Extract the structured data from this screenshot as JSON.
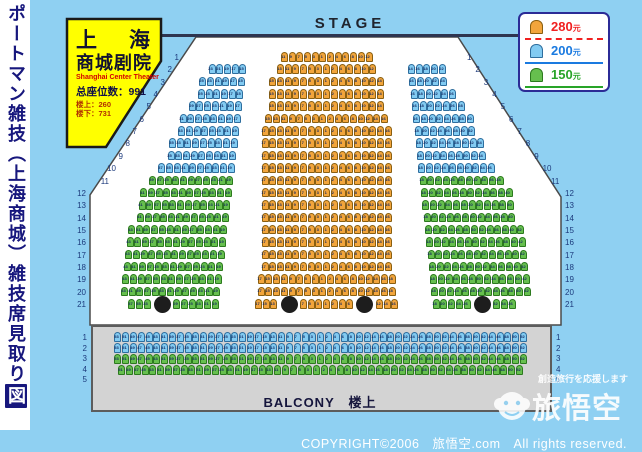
{
  "page": {
    "background": "#8fd0f2",
    "hall_fill": "#ffffff",
    "balcony_fill": "#d3d3d3"
  },
  "vertical_title": {
    "main": "ポートマン雑技（上海商城）雑技席見取り",
    "boxed": "図"
  },
  "stage": {
    "label": "STAGE"
  },
  "info_box": {
    "name_left": "上",
    "name_right": "海",
    "name_line2": "商城剧院",
    "name_en": "Shanghai Center Theater",
    "total_seats": "总座位数：991",
    "upstairs": "楼上：260",
    "downstairs": "楼下：731"
  },
  "legend": [
    {
      "price": "280",
      "unit": "元",
      "seat_color_key": "orange",
      "text_color": "#f02020",
      "underline": "dashed"
    },
    {
      "price": "200",
      "unit": "元",
      "seat_color_key": "blue",
      "text_color": "#1a7ae0",
      "underline": "solid"
    },
    {
      "price": "150",
      "unit": "元",
      "seat_color_key": "green",
      "text_color": "#28a428",
      "underline": "solid"
    }
  ],
  "seat_colors": {
    "orange": {
      "fill": "#f2a53c",
      "border": "#8a5f10"
    },
    "blue": {
      "fill": "#82cbf2",
      "border": "#2e6e9e"
    },
    "green": {
      "fill": "#66bf4e",
      "border": "#2c7a1e"
    }
  },
  "pillars": {
    "count": 4,
    "color": "#1d1d1d"
  },
  "floor": {
    "row_labels_left": [
      1,
      2,
      3,
      4,
      5,
      6,
      7,
      8,
      9,
      10,
      11,
      12,
      13,
      14,
      15,
      16,
      17,
      18,
      19,
      20,
      21
    ],
    "row_labels_right": [
      1,
      2,
      3,
      4,
      5,
      6,
      7,
      8,
      9,
      10,
      11,
      12,
      13,
      14,
      15,
      16,
      17,
      18,
      19,
      20,
      21
    ],
    "left_rows": [
      {
        "row": 2,
        "color": "blue",
        "odd_from": 23,
        "odd_to": 15
      },
      {
        "row": 3,
        "color": "blue",
        "odd_from": 25,
        "odd_to": 15
      },
      {
        "row": 4,
        "color": "blue",
        "odd_from": 25,
        "odd_to": 15
      },
      {
        "row": 5,
        "color": "blue",
        "odd_from": 29,
        "odd_to": 17
      },
      {
        "row": 6,
        "color": "blue",
        "odd_from": 31,
        "odd_to": 17
      },
      {
        "row": 7,
        "color": "blue",
        "odd_from": 33,
        "odd_to": 19
      },
      {
        "row": 8,
        "color": "blue",
        "odd_from": 35,
        "odd_to": 19
      },
      {
        "row": 9,
        "color": "blue",
        "odd_from": 35,
        "odd_to": 19
      },
      {
        "row": 10,
        "color": "blue",
        "odd_from": 37,
        "odd_to": 19
      },
      {
        "row": 11,
        "color": "green",
        "odd_from": 39,
        "odd_to": 19
      },
      {
        "row": 12,
        "color": "green",
        "odd_from": 41,
        "odd_to": 19
      },
      {
        "row": 13,
        "color": "green",
        "odd_from": 41,
        "odd_to": 19
      },
      {
        "row": 14,
        "color": "green",
        "odd_from": 41,
        "odd_to": 19
      },
      {
        "row": 15,
        "color": "green",
        "odd_from": 43,
        "odd_to": 19
      },
      {
        "row": 16,
        "color": "green",
        "odd_from": 43,
        "odd_to": 19
      },
      {
        "row": 17,
        "color": "green",
        "odd_from": 43,
        "odd_to": 19
      },
      {
        "row": 18,
        "color": "green",
        "odd_from": 43,
        "odd_to": 19
      },
      {
        "row": 19,
        "color": "green",
        "odd_from": 43,
        "odd_to": 19
      },
      {
        "row": 20,
        "color": "green",
        "odd_from": 43,
        "odd_to": 19
      },
      {
        "row": 21,
        "color": "green",
        "groups": [
          [
            37,
            35,
            33
          ],
          [
            29,
            27,
            25,
            23,
            21,
            19
          ]
        ]
      }
    ],
    "center_rows": [
      {
        "row": 1,
        "color": "orange",
        "max_odd": 11,
        "max_even": 12
      },
      {
        "row": 2,
        "color": "orange",
        "max_odd": 13,
        "max_even": 12
      },
      {
        "row": 3,
        "color": "orange",
        "max_odd": 15,
        "max_even": 14
      },
      {
        "row": 4,
        "color": "orange",
        "max_odd": 15,
        "max_even": 14
      },
      {
        "row": 5,
        "color": "orange",
        "max_odd": 15,
        "max_even": 14
      },
      {
        "row": 6,
        "color": "orange",
        "max_odd": 15,
        "max_even": 16
      },
      {
        "row": 7,
        "color": "orange",
        "max_odd": 17,
        "max_even": 16
      },
      {
        "row": 8,
        "color": "orange",
        "max_odd": 17,
        "max_even": 16
      },
      {
        "row": 9,
        "color": "orange",
        "max_odd": 17,
        "max_even": 16
      },
      {
        "row": 10,
        "color": "orange",
        "max_odd": 17,
        "max_even": 16
      },
      {
        "row": 11,
        "color": "orange",
        "max_odd": 17,
        "max_even": 16
      },
      {
        "row": 12,
        "color": "orange",
        "max_odd": 17,
        "max_even": 16
      },
      {
        "row": 13,
        "color": "orange",
        "max_odd": 17,
        "max_even": 16
      },
      {
        "row": 14,
        "color": "orange",
        "max_odd": 17,
        "max_even": 16
      },
      {
        "row": 15,
        "color": "orange",
        "max_odd": 17,
        "max_even": 16
      },
      {
        "row": 16,
        "color": "orange",
        "max_odd": 17,
        "max_even": 16
      },
      {
        "row": 17,
        "color": "orange",
        "max_odd": 17,
        "max_even": 16
      },
      {
        "row": 18,
        "color": "orange",
        "max_odd": 17,
        "max_even": 16
      },
      {
        "row": 19,
        "color": "orange",
        "max_odd": 17,
        "max_even": 18
      },
      {
        "row": 20,
        "color": "orange",
        "max_odd": 17,
        "max_even": 18
      },
      {
        "row": 21,
        "color": "orange",
        "groups": [
          [
            17,
            15,
            13
          ],
          [
            7,
            5,
            3,
            1,
            2,
            4,
            6
          ],
          [
            12,
            14,
            16
          ]
        ]
      }
    ],
    "right_rows": [
      {
        "row": 2,
        "color": "blue",
        "even_from": 14,
        "even_to": 22
      },
      {
        "row": 3,
        "color": "blue",
        "even_from": 16,
        "even_to": 24
      },
      {
        "row": 4,
        "color": "blue",
        "even_from": 16,
        "even_to": 26
      },
      {
        "row": 5,
        "color": "blue",
        "even_from": 16,
        "even_to": 28
      },
      {
        "row": 6,
        "color": "blue",
        "even_from": 16,
        "even_to": 30
      },
      {
        "row": 7,
        "color": "blue",
        "even_from": 18,
        "even_to": 32
      },
      {
        "row": 8,
        "color": "blue",
        "even_from": 18,
        "even_to": 34
      },
      {
        "row": 9,
        "color": "blue",
        "even_from": 18,
        "even_to": 34
      },
      {
        "row": 10,
        "color": "blue",
        "even_from": 18,
        "even_to": 36
      },
      {
        "row": 11,
        "color": "green",
        "even_from": 18,
        "even_to": 38
      },
      {
        "row": 12,
        "color": "green",
        "even_from": 18,
        "even_to": 40
      },
      {
        "row": 13,
        "color": "green",
        "even_from": 18,
        "even_to": 40
      },
      {
        "row": 14,
        "color": "green",
        "even_from": 18,
        "even_to": 40
      },
      {
        "row": 15,
        "color": "green",
        "even_from": 18,
        "even_to": 42
      },
      {
        "row": 16,
        "color": "green",
        "even_from": 18,
        "even_to": 42
      },
      {
        "row": 17,
        "color": "green",
        "even_from": 18,
        "even_to": 42
      },
      {
        "row": 18,
        "color": "green",
        "even_from": 18,
        "even_to": 42
      },
      {
        "row": 19,
        "color": "green",
        "even_from": 18,
        "even_to": 42
      },
      {
        "row": 20,
        "color": "green",
        "even_from": 18,
        "even_to": 42
      },
      {
        "row": 21,
        "color": "green",
        "groups": [
          [
            18,
            20,
            22,
            24,
            26
          ],
          [
            32,
            34,
            36
          ]
        ]
      }
    ]
  },
  "balcony": {
    "label": "BALCONY　楼上",
    "row_labels": [
      1,
      2,
      3,
      4,
      5
    ],
    "rows": [
      {
        "row": 1,
        "color": "blue",
        "max_odd": 53,
        "max_even": 52
      },
      {
        "row": 2,
        "color": "blue",
        "max_odd": 53,
        "max_even": 52
      },
      {
        "row": 3,
        "color": "green",
        "max_odd": 53,
        "max_even": 52
      },
      {
        "row": 4,
        "color": "green",
        "max_odd": 51,
        "max_even": 52
      }
    ]
  },
  "watermark": {
    "tagline": "創造旅行を応援します",
    "brand": "旅悟空"
  },
  "copyright": "COPYRIGHT©2006　旅悟空.com　All rights reserved."
}
